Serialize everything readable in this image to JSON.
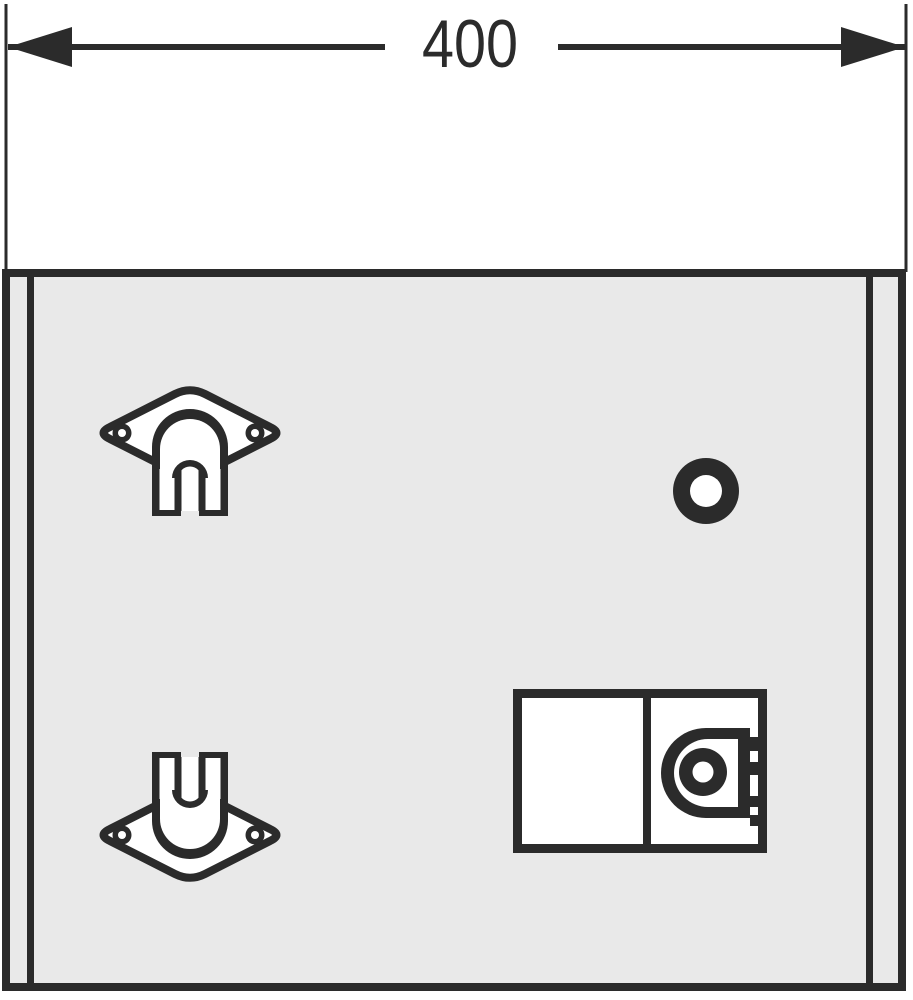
{
  "drawing": {
    "dimension": {
      "label": "400"
    },
    "colors": {
      "ink": "#2b2b2b",
      "panel": "#e9e9e9",
      "paper": "#ffffff"
    },
    "components": [
      "width-dimension-line",
      "front-panel",
      "hanger-bracket-top",
      "hanger-bracket-bottom",
      "mounting-hole",
      "coin-lock-module"
    ]
  }
}
